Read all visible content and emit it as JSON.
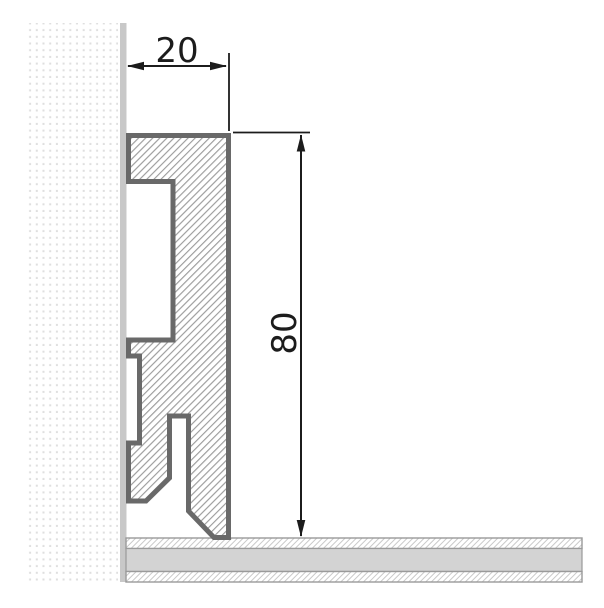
{
  "dimensions": {
    "width": {
      "label": "20"
    },
    "height": {
      "label": "80"
    }
  },
  "colors": {
    "outline": "#696969",
    "hatch": "#9c9c9c",
    "wall_dot": "#dfdfdf",
    "wall_strip": "#c8c8c8",
    "floor_solid": "#d3d3d3",
    "floor_border": "#9a9a9a",
    "floor_hatch": "#c9c9c9",
    "dimension": "#1c1c1c",
    "background": "#ffffff"
  }
}
